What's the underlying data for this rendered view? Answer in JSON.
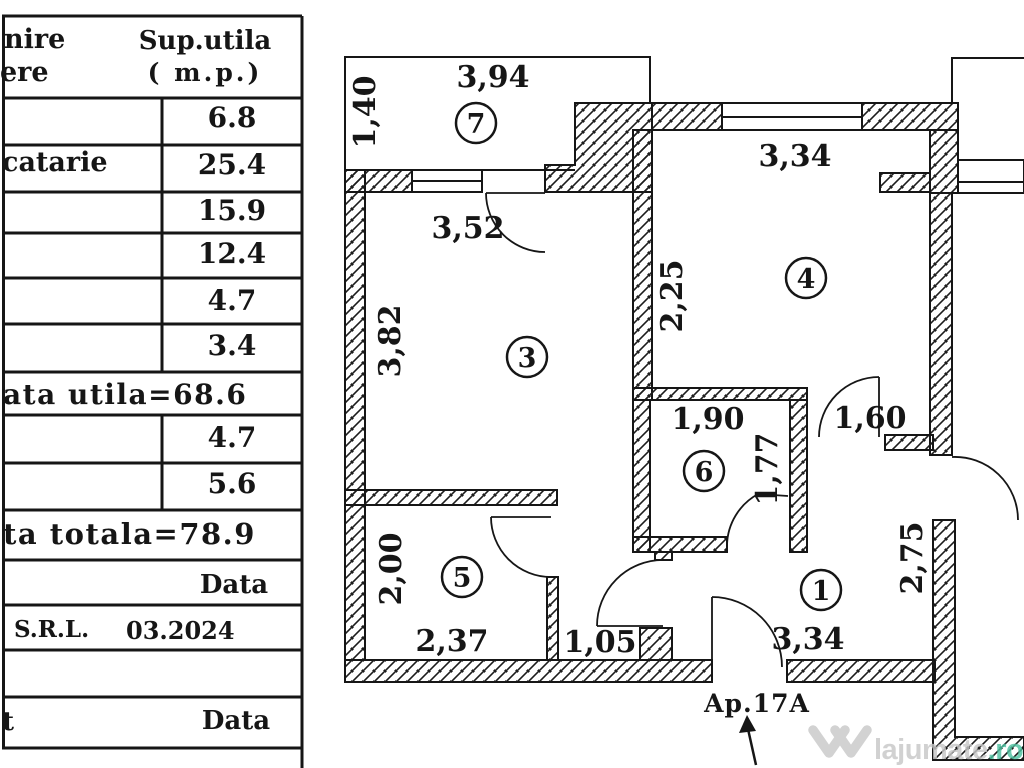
{
  "table": {
    "header": {
      "name_col_top": "nire",
      "name_col_bottom": "ere",
      "area_col_top": "Sup.utila",
      "area_col_bottom": "( m.p.)"
    },
    "rows": [
      {
        "name": "",
        "area": "6.8"
      },
      {
        "name": "catarie",
        "area": "25.4"
      },
      {
        "name": "",
        "area": "15.9"
      },
      {
        "name": "",
        "area": "12.4"
      },
      {
        "name": "",
        "area": "4.7"
      },
      {
        "name": "",
        "area": "3.4"
      }
    ],
    "useful_total": "ata utila=68.6",
    "extra_rows": [
      {
        "area": "4.7"
      },
      {
        "area": "5.6"
      }
    ],
    "grand_total": "ta totala=78.9",
    "footer": {
      "data_label_1": "Data",
      "company_suffix": "S.R.L.",
      "date": "03.2024",
      "cut_text": "t",
      "data_label_2": "Data"
    }
  },
  "plan": {
    "apartment_label": "Ap.17A",
    "room_numbers": {
      "r1": "1",
      "r3": "3",
      "r4": "4",
      "r5": "5",
      "r6": "6",
      "r7": "7"
    },
    "dims": {
      "balcony_width": "3,94",
      "balcony_depth": "1,40",
      "room4_width": "3,34",
      "room3_width": "3,52",
      "room3_height": "3,82",
      "room4_left": "2,25",
      "room6_width": "1,90",
      "hall_door": "1,60",
      "room6_height": "1,77",
      "room5_height": "2,00",
      "room5_width": "2,37",
      "corridor": "1,05",
      "hall_width": "3,34",
      "hall_right": "2,75"
    }
  },
  "watermark": {
    "brand": "lajumate",
    "tld": ".ro",
    "gray": "#c7c7c7",
    "green": "#4fc0a0"
  },
  "colors": {
    "ink": "#161616"
  }
}
